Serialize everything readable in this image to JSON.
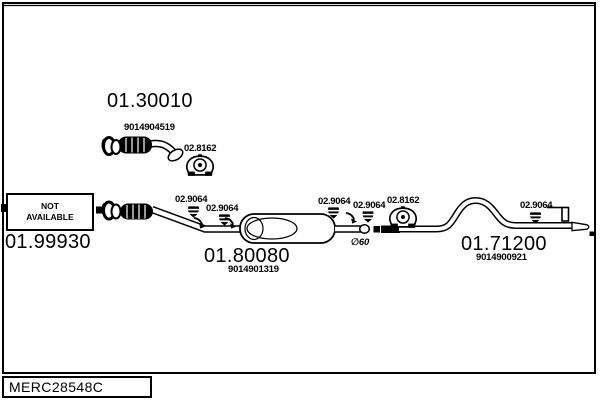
{
  "colors": {
    "ink": "#000000",
    "paper": "#ffffff"
  },
  "parts": {
    "front_pipe": {
      "number": "01.30010",
      "oe": "9014904519"
    },
    "flex_pipe": {
      "number": "01.99930",
      "status_line1": "NOT",
      "status_line2": "AVAILABLE"
    },
    "center_muffler": {
      "number": "01.80080",
      "oe": "9014901319"
    },
    "rear_pipe": {
      "number": "01.71200",
      "oe": "9014900921"
    }
  },
  "fittings": {
    "clamp_top": "02.8162",
    "clamp_right": "02.8162",
    "hanger_1": "02.9064",
    "hanger_2": "02.9064",
    "hanger_3": "02.9064",
    "hanger_4": "02.9064",
    "hanger_5": "02.9064"
  },
  "annotations": {
    "pipe_diameter": "∅60"
  },
  "footer": {
    "code": "MERC28548C"
  },
  "icons": {
    "hanger_icon": "striped-rubber-hanger",
    "clamp_icon": "rubber-mount-bracket",
    "arrow_icon": "attachment-arrow"
  }
}
